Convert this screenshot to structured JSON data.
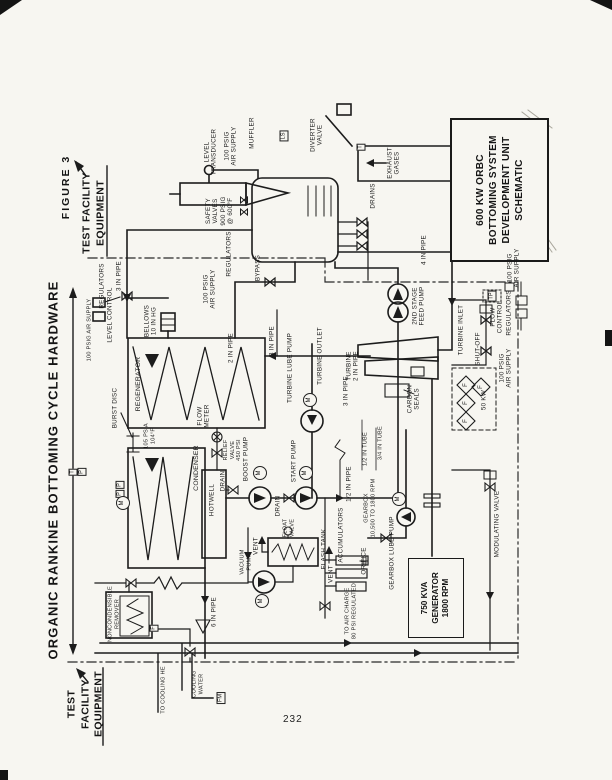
{
  "page": {
    "figure_label": "FIGURE 3",
    "side_title": "ORGANIC RANKINE BOTTOMING CYCLE HARDWARE",
    "test_facility_top": "TEST FACILITY\nEQUIPMENT",
    "test_facility_bottom": "TEST\nFACILITY\nEQUIPMENT",
    "page_number": "232"
  },
  "title_block": {
    "lines": [
      "600 KW ORBC",
      "BOTTOMING SYSTEM",
      "DEVELOPMENT UNIT",
      "SCHEMATIC"
    ]
  },
  "diagram": {
    "generator": {
      "lines": [
        "750 KVA",
        "GENERATOR",
        "1800 RPM"
      ]
    },
    "labels": [
      {
        "id": "muffler",
        "t": "MUFFLER",
        "x": 252,
        "y": 133
      },
      {
        "id": "diverter-valve",
        "t": "DIVERTER\nVALVE",
        "x": 317,
        "y": 135
      },
      {
        "id": "level-transducer",
        "t": "LEVEL\nTRANSDUCER",
        "x": 211,
        "y": 152
      },
      {
        "id": "air-supply-transducer",
        "t": "100 PSIG\nAIR SUPPLY",
        "x": 231,
        "y": 146
      },
      {
        "id": "safety-valves",
        "t": "SAFETY\nVALVES\n900 PSIG\n@ 600°F",
        "x": 220,
        "y": 211
      },
      {
        "id": "exhaust-gases",
        "t": "EXHAUST\nGASES",
        "x": 394,
        "y": 163
      },
      {
        "id": "drains",
        "t": "DRAINS",
        "x": 373,
        "y": 196
      },
      {
        "id": "pipe-4in",
        "t": "4 IN PIPE",
        "x": 424,
        "y": 250
      },
      {
        "id": "bypass",
        "t": "BYPASS",
        "x": 258,
        "y": 268
      },
      {
        "id": "regulators-boiler",
        "t": "REGULATORS",
        "x": 229,
        "y": 254
      },
      {
        "id": "air-supply-boiler",
        "t": "100 PSIG\nAIR SUPPLY",
        "x": 210,
        "y": 289
      },
      {
        "id": "bellows",
        "t": "BELLOWS\n10 IN HG",
        "x": 151,
        "y": 321
      },
      {
        "id": "air-supply-level",
        "t": "100 PSIG AIR SUPPLY",
        "x": 90,
        "y": 330,
        "fs": 5.6
      },
      {
        "id": "regulators-level",
        "t": "REGULATORS",
        "x": 102,
        "y": 286
      },
      {
        "id": "level-control",
        "t": "LEVEL CONTROL",
        "x": 110,
        "y": 315
      },
      {
        "id": "pipe-3in-left",
        "t": "3 IN PIPE",
        "x": 119,
        "y": 276
      },
      {
        "id": "pipe-2in",
        "t": "2 IN PIPE",
        "x": 231,
        "y": 348
      },
      {
        "id": "regenerator",
        "t": "REGENERATOR",
        "x": 139,
        "y": 384,
        "fs": 6.8
      },
      {
        "id": "burst-disc",
        "t": "BURST DISC",
        "x": 115,
        "y": 408
      },
      {
        "id": "cond-conditions",
        "t": "105 PSIA\n104°F",
        "x": 150,
        "y": 436,
        "fs": 5.6
      },
      {
        "id": "condenser",
        "t": "CONDENSER",
        "x": 197,
        "y": 468,
        "fs": 6.8
      },
      {
        "id": "hotwell",
        "t": "HOTWELL",
        "x": 212,
        "y": 500
      },
      {
        "id": "flow-meter",
        "t": "FLOW\nMETER",
        "x": 204,
        "y": 416
      },
      {
        "id": "relief-valve",
        "t": "RELIEF\nVALVE\n450 PSI",
        "x": 233,
        "y": 450,
        "fs": 5.6
      },
      {
        "id": "drain-1",
        "t": "DRAIN",
        "x": 223,
        "y": 481
      },
      {
        "id": "drain-2",
        "t": "DRAIN",
        "x": 278,
        "y": 506
      },
      {
        "id": "pipe-3in-lube",
        "t": "3 IN PIPE",
        "x": 272,
        "y": 341
      },
      {
        "id": "turbine-lube-pump",
        "t": "TURBINE LUBE PUMP",
        "x": 290,
        "y": 368
      },
      {
        "id": "turbine-outlet",
        "t": "TURBINE OUTLET",
        "x": 320,
        "y": 356
      },
      {
        "id": "turbine-2in",
        "t": "TURBINE\n2 IN PIPE",
        "x": 353,
        "y": 366
      },
      {
        "id": "pipe-3in-turb",
        "t": "3 IN PIPE",
        "x": 346,
        "y": 391
      },
      {
        "id": "boost-pump",
        "t": "BOOST PUMP",
        "x": 246,
        "y": 459
      },
      {
        "id": "start-pump",
        "t": "START PUMP",
        "x": 294,
        "y": 461
      },
      {
        "id": "pipe-half-in",
        "t": "1/2 IN PIPE",
        "x": 349,
        "y": 484
      },
      {
        "id": "tube-half-in",
        "t": "1/2 IN TUBE",
        "x": 366,
        "y": 449,
        "fs": 5.6
      },
      {
        "id": "tube-34-in",
        "t": "3/4 IN TUBE",
        "x": 381,
        "y": 443,
        "fs": 5.6
      },
      {
        "id": "feed-pump",
        "t": "2ND STAGE\nFEED PUMP",
        "x": 419,
        "y": 306
      },
      {
        "id": "turbine-inlet",
        "t": "TURBINE INLET",
        "x": 461,
        "y": 330
      },
      {
        "id": "flow-control",
        "t": "FLOW\nCONTROL",
        "x": 497,
        "y": 317
      },
      {
        "id": "shut-off",
        "t": "SHUT-OFF",
        "x": 478,
        "y": 349
      },
      {
        "id": "air-supply-turbine",
        "t": "100 PSIG\nAIR SUPPLY",
        "x": 506,
        "y": 368
      },
      {
        "id": "regulators-turbine",
        "t": "REGULATORS",
        "x": 509,
        "y": 313
      },
      {
        "id": "air-supply-right",
        "t": "100 PSIG\nAIR SUPPLY",
        "x": 514,
        "y": 268
      },
      {
        "id": "carbon-seals",
        "t": "CARBON\nSEALS",
        "x": 414,
        "y": 399
      },
      {
        "id": "heater-50kw",
        "t": "50 KW",
        "x": 484,
        "y": 400
      },
      {
        "id": "gearbox",
        "t": "GEARBOX\n10,500 TO 1800 RPM",
        "x": 370,
        "y": 508,
        "fs": 5.6
      },
      {
        "id": "gearbox-lube-pump",
        "t": "GEARBOX LUBE PUMP",
        "x": 392,
        "y": 553
      },
      {
        "id": "modulating-valve",
        "t": "MODULATING VALVE",
        "x": 497,
        "y": 524
      },
      {
        "id": "accumulators",
        "t": "ACCUMULATORS",
        "x": 341,
        "y": 535
      },
      {
        "id": "orifice",
        "t": "ORIFICE",
        "x": 364,
        "y": 561
      },
      {
        "id": "vent-accum",
        "t": "VENT",
        "x": 331,
        "y": 574
      },
      {
        "id": "air-charge",
        "t": "TO AIR CHARGE\n80 PSI REGULATED",
        "x": 351,
        "y": 611,
        "fs": 5.6
      },
      {
        "id": "flash-tank",
        "t": "FLASH TANK",
        "x": 324,
        "y": 549
      },
      {
        "id": "float-valve",
        "t": "FLOAT\nVALVE",
        "x": 289,
        "y": 528,
        "fs": 5.6
      },
      {
        "id": "vent-flash",
        "t": "VENT",
        "x": 256,
        "y": 546
      },
      {
        "id": "vacuum-pump",
        "t": "VACUUM\nPUMP",
        "x": 246,
        "y": 562,
        "fs": 5.6
      },
      {
        "id": "noncondensible",
        "t": "NONCONDENSIBLE\nREMOVER",
        "x": 114,
        "y": 614,
        "fs": 5.6
      },
      {
        "id": "pipe-6in",
        "t": "6 IN PIPE",
        "x": 214,
        "y": 612
      },
      {
        "id": "to-cooling",
        "t": "TO COOLING HE",
        "x": 164,
        "y": 690,
        "fs": 5.6
      },
      {
        "id": "cooling-water",
        "t": "COOLING\nWATER",
        "x": 198,
        "y": 684,
        "fs": 5.6
      }
    ],
    "tags": [
      {
        "t": "LS",
        "x": 284,
        "y": 136,
        "k": "box"
      },
      {
        "t": "T",
        "x": 361,
        "y": 147,
        "k": "box"
      },
      {
        "t": "TP",
        "x": 492,
        "y": 296,
        "k": "box"
      },
      {
        "t": "T",
        "x": 73,
        "y": 472,
        "k": "box"
      },
      {
        "t": "P",
        "x": 82,
        "y": 472,
        "k": "box"
      },
      {
        "t": "P",
        "x": 120,
        "y": 485,
        "k": "box"
      },
      {
        "t": "P",
        "x": 120,
        "y": 494,
        "k": "box"
      },
      {
        "t": "M",
        "x": 260,
        "y": 473,
        "k": "circle"
      },
      {
        "t": "M",
        "x": 306,
        "y": 473,
        "k": "circle"
      },
      {
        "t": "M",
        "x": 310,
        "y": 400,
        "k": "circle"
      },
      {
        "t": "M",
        "x": 399,
        "y": 499,
        "k": "circle"
      },
      {
        "t": "M",
        "x": 262,
        "y": 601,
        "k": "circle"
      },
      {
        "t": "M",
        "x": 123,
        "y": 503,
        "k": "circle"
      },
      {
        "t": "F",
        "x": 466,
        "y": 385,
        "k": "plain"
      },
      {
        "t": "F",
        "x": 466,
        "y": 403,
        "k": "plain"
      },
      {
        "t": "F",
        "x": 466,
        "y": 421,
        "k": "plain"
      },
      {
        "t": "F",
        "x": 481,
        "y": 387,
        "k": "plain"
      },
      {
        "t": "FM",
        "x": 221,
        "y": 698,
        "k": "box"
      },
      {
        "t": "F",
        "x": 154,
        "y": 628,
        "k": "box"
      }
    ]
  }
}
